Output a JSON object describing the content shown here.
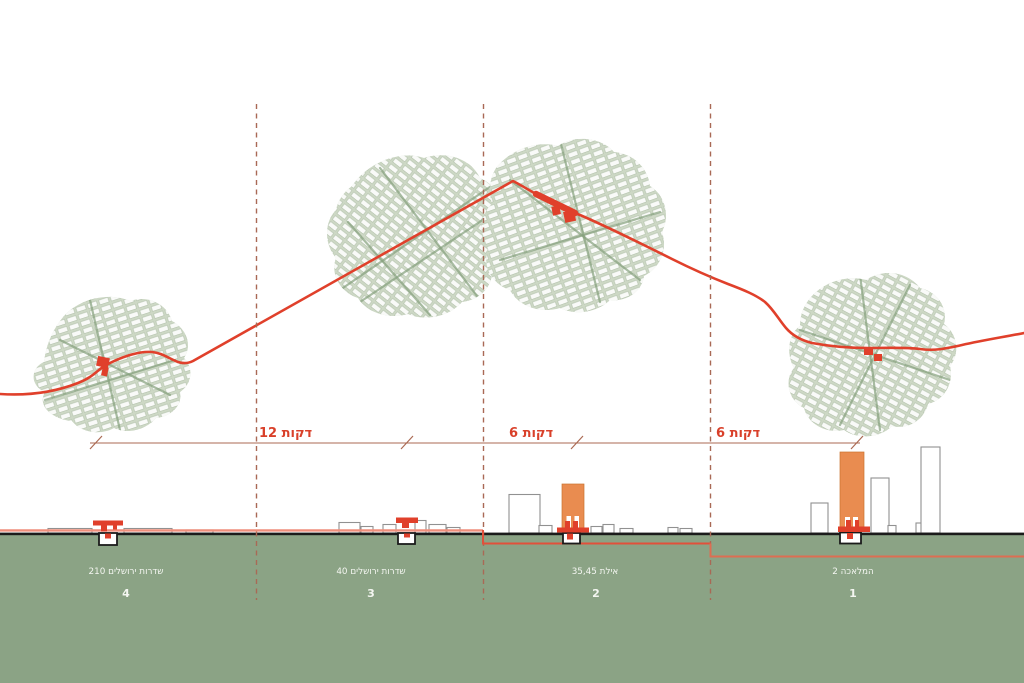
{
  "timeline": {
    "segments": [
      {
        "label": "12 דקות"
      },
      {
        "label": "6 דקות"
      },
      {
        "label": "6 דקות"
      }
    ]
  },
  "stations": [
    {
      "number": "4",
      "name": "שדרות ירושלים 210"
    },
    {
      "number": "3",
      "name": "שדרות ירושלים 40"
    },
    {
      "number": "2",
      "name": "אילת 35,45"
    },
    {
      "number": "1",
      "name": "המלאכה 2"
    }
  ],
  "colors": {
    "route_red": "#e0402b",
    "dashed_divider": "#a96955",
    "measure_line": "#ab6a53",
    "time_label": "#d9402a",
    "map_fill": "#cdd8c5",
    "map_street": "#84a07c",
    "ground_green": "#8ba385",
    "ground_line": "#1b1b1b",
    "tower_orange": "#e98c50",
    "building_outline": "#919191",
    "profile_above": "#ef8e7b",
    "profile_below": "#e2503a",
    "profile_deep": "#dd6e52",
    "label_white": "#f4f6f1"
  }
}
